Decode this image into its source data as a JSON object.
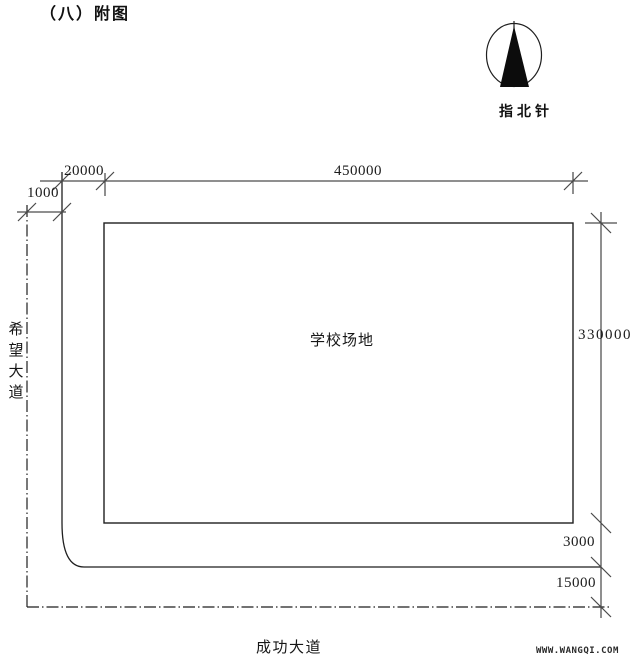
{
  "title": "（八）附图",
  "compass": {
    "label": "指北针"
  },
  "field": {
    "label": "学校场地"
  },
  "roads": {
    "left_name": "希望大道",
    "bottom_name": "成功大道"
  },
  "dimensions": {
    "road_half_width": "1000",
    "setback_left": "20000",
    "field_width": "450000",
    "field_height": "330000",
    "setback_bottom": "3000",
    "road_offset_bottom": "15000"
  },
  "watermark": "WWW.WANGQI.COM",
  "colors": {
    "line": "#1f1f1f",
    "tick": "#4a4a4a",
    "background": "#ffffff"
  }
}
